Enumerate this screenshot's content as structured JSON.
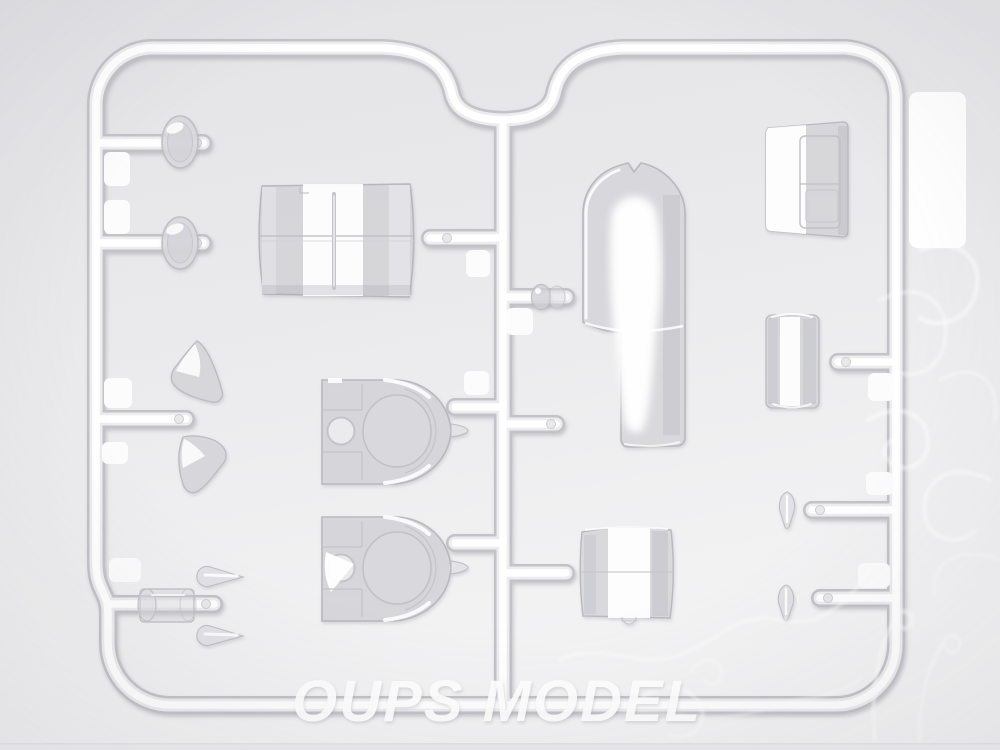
{
  "photo": {
    "subject": "Clear transparent plastic sprue (runner with clear canopy and window parts) from a scale model kit, photographed on a light gray background",
    "watermark": {
      "logo_text": "OUPS MODEL",
      "ornament": "dragon-swirl-line-art",
      "color": "#ffffff"
    },
    "colors": {
      "background_top": "#e5e5e8",
      "background_bottom": "#f4f4f5",
      "sprue_highlight": "#ffffff",
      "sprue_edge": "#c2c2c7",
      "part_tint": "#d8d8dc",
      "part_edge": "#b6b6bc",
      "label_patch": "#ffffff"
    },
    "parts": [
      {
        "name": "porthole-window-top",
        "shape": "small clear oval window"
      },
      {
        "name": "porthole-window-bottom",
        "shape": "small clear oval window"
      },
      {
        "name": "canopy-mid-section",
        "shape": "wide curved rectangular glazing with panel lines"
      },
      {
        "name": "triangle-window-top",
        "shape": "rounded triangular window"
      },
      {
        "name": "triangle-window-bottom",
        "shape": "rounded triangular window"
      },
      {
        "name": "turret-dome-top",
        "shape": "dome glazing with round opening and side pin"
      },
      {
        "name": "turret-dome-bottom",
        "shape": "dome glazing with round opening and side pin"
      },
      {
        "name": "landing-light-top",
        "shape": "teardrop lens"
      },
      {
        "name": "landing-light-bottom",
        "shape": "teardrop lens"
      },
      {
        "name": "cylinder-lens",
        "shape": "small clear cylinder over runner"
      },
      {
        "name": "nose-glazing",
        "shape": "long arched canopy with bright reflection"
      },
      {
        "name": "canopy-rear-section",
        "shape": "trapezoid glazing with framed panel lines"
      },
      {
        "name": "drum-cylinder",
        "shape": "vertical clear cylinder"
      },
      {
        "name": "fuselage-window-section",
        "shape": "curved rectangular glazing with bottom notch"
      },
      {
        "name": "small-teardrop-top",
        "shape": "tiny teardrop lens"
      },
      {
        "name": "small-teardrop-bottom",
        "shape": "tiny teardrop lens"
      },
      {
        "name": "round-lens",
        "shape": "tiny cylindrical lens attached to center runner"
      }
    ]
  }
}
